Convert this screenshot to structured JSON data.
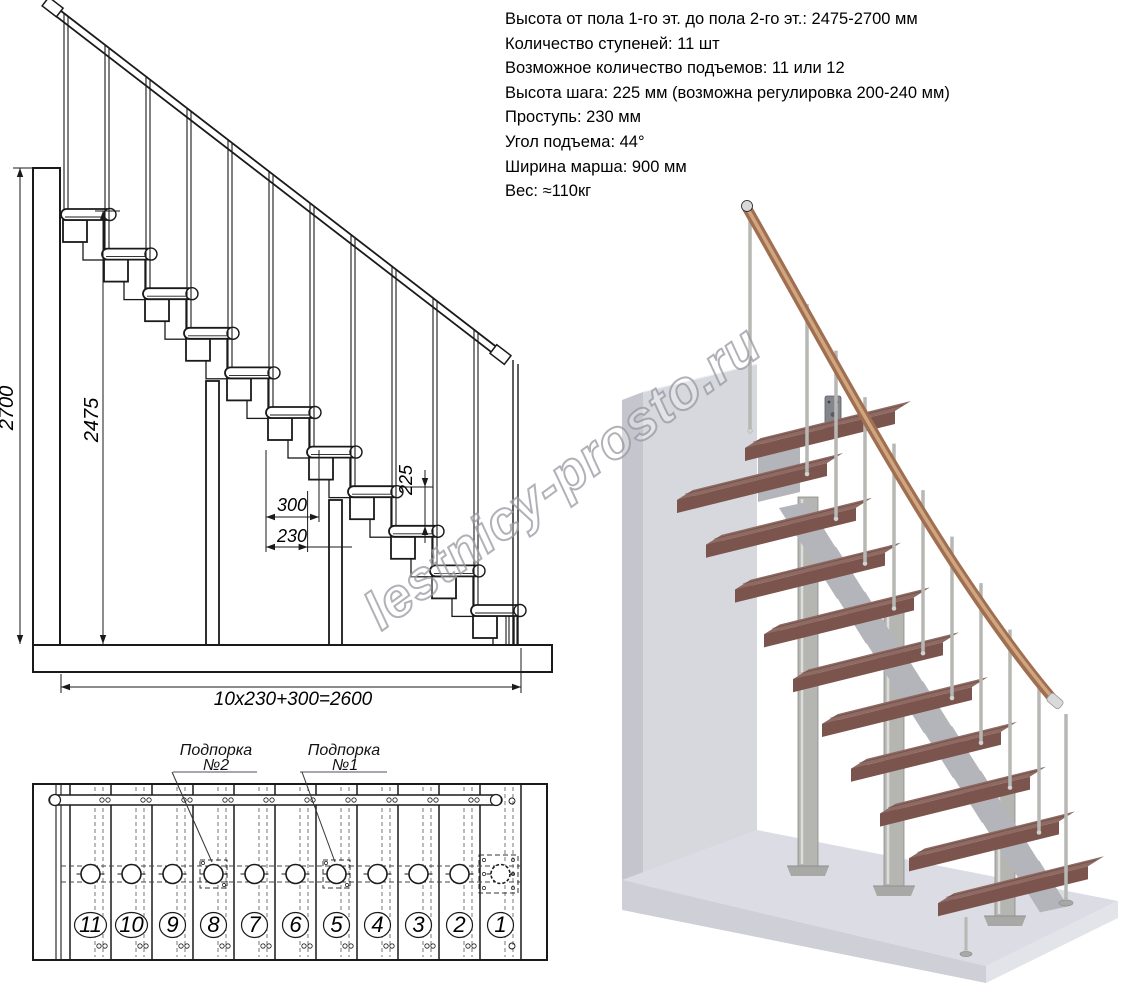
{
  "specs": {
    "lines": [
      "Высота от пола 1-го эт. до пола 2-го эт.: 2475-2700 мм",
      "Количество ступеней: 11 шт",
      "Возможное количество подъемов: 11 или 12",
      "Высота шага: 225 мм (возможна регулировка 200-240 мм)",
      "Проступь: 230 мм",
      "Угол подъема: 44°",
      "Ширина марша: 900 мм",
      "Вес: ≈110кг"
    ]
  },
  "elevation": {
    "steps": 11,
    "dims": {
      "h_total": "2700",
      "h_top": "2475",
      "rise": "225",
      "depth": "300",
      "run": "230",
      "total": "10x230+300=2600"
    }
  },
  "plan": {
    "step_numbers": [
      "11",
      "10",
      "9",
      "8",
      "7",
      "6",
      "5",
      "4",
      "3",
      "2",
      "1"
    ],
    "supports": [
      {
        "line1": "Подпорка",
        "line2": "№2",
        "step": "8"
      },
      {
        "line1": "Подпорка",
        "line2": "№1",
        "step": "5"
      }
    ]
  },
  "watermark": {
    "text": "lestnicy-prosto.ru"
  },
  "render3d": {
    "colors": {
      "wall_front": "#d7d8de",
      "wall_side": "#c5c6cd",
      "floor_top": "#dcdde4",
      "floor_front": "#cfd0d7",
      "floor_right": "#e3e4e9",
      "tread_top": "#8e6a63",
      "tread_front": "#7b544d",
      "tread_side": "#6c4842",
      "metal": "#b5b5b2",
      "metal_dark": "#8a8a88",
      "handrail": "#a06e50",
      "handrail_hi": "#cfa67f"
    }
  }
}
